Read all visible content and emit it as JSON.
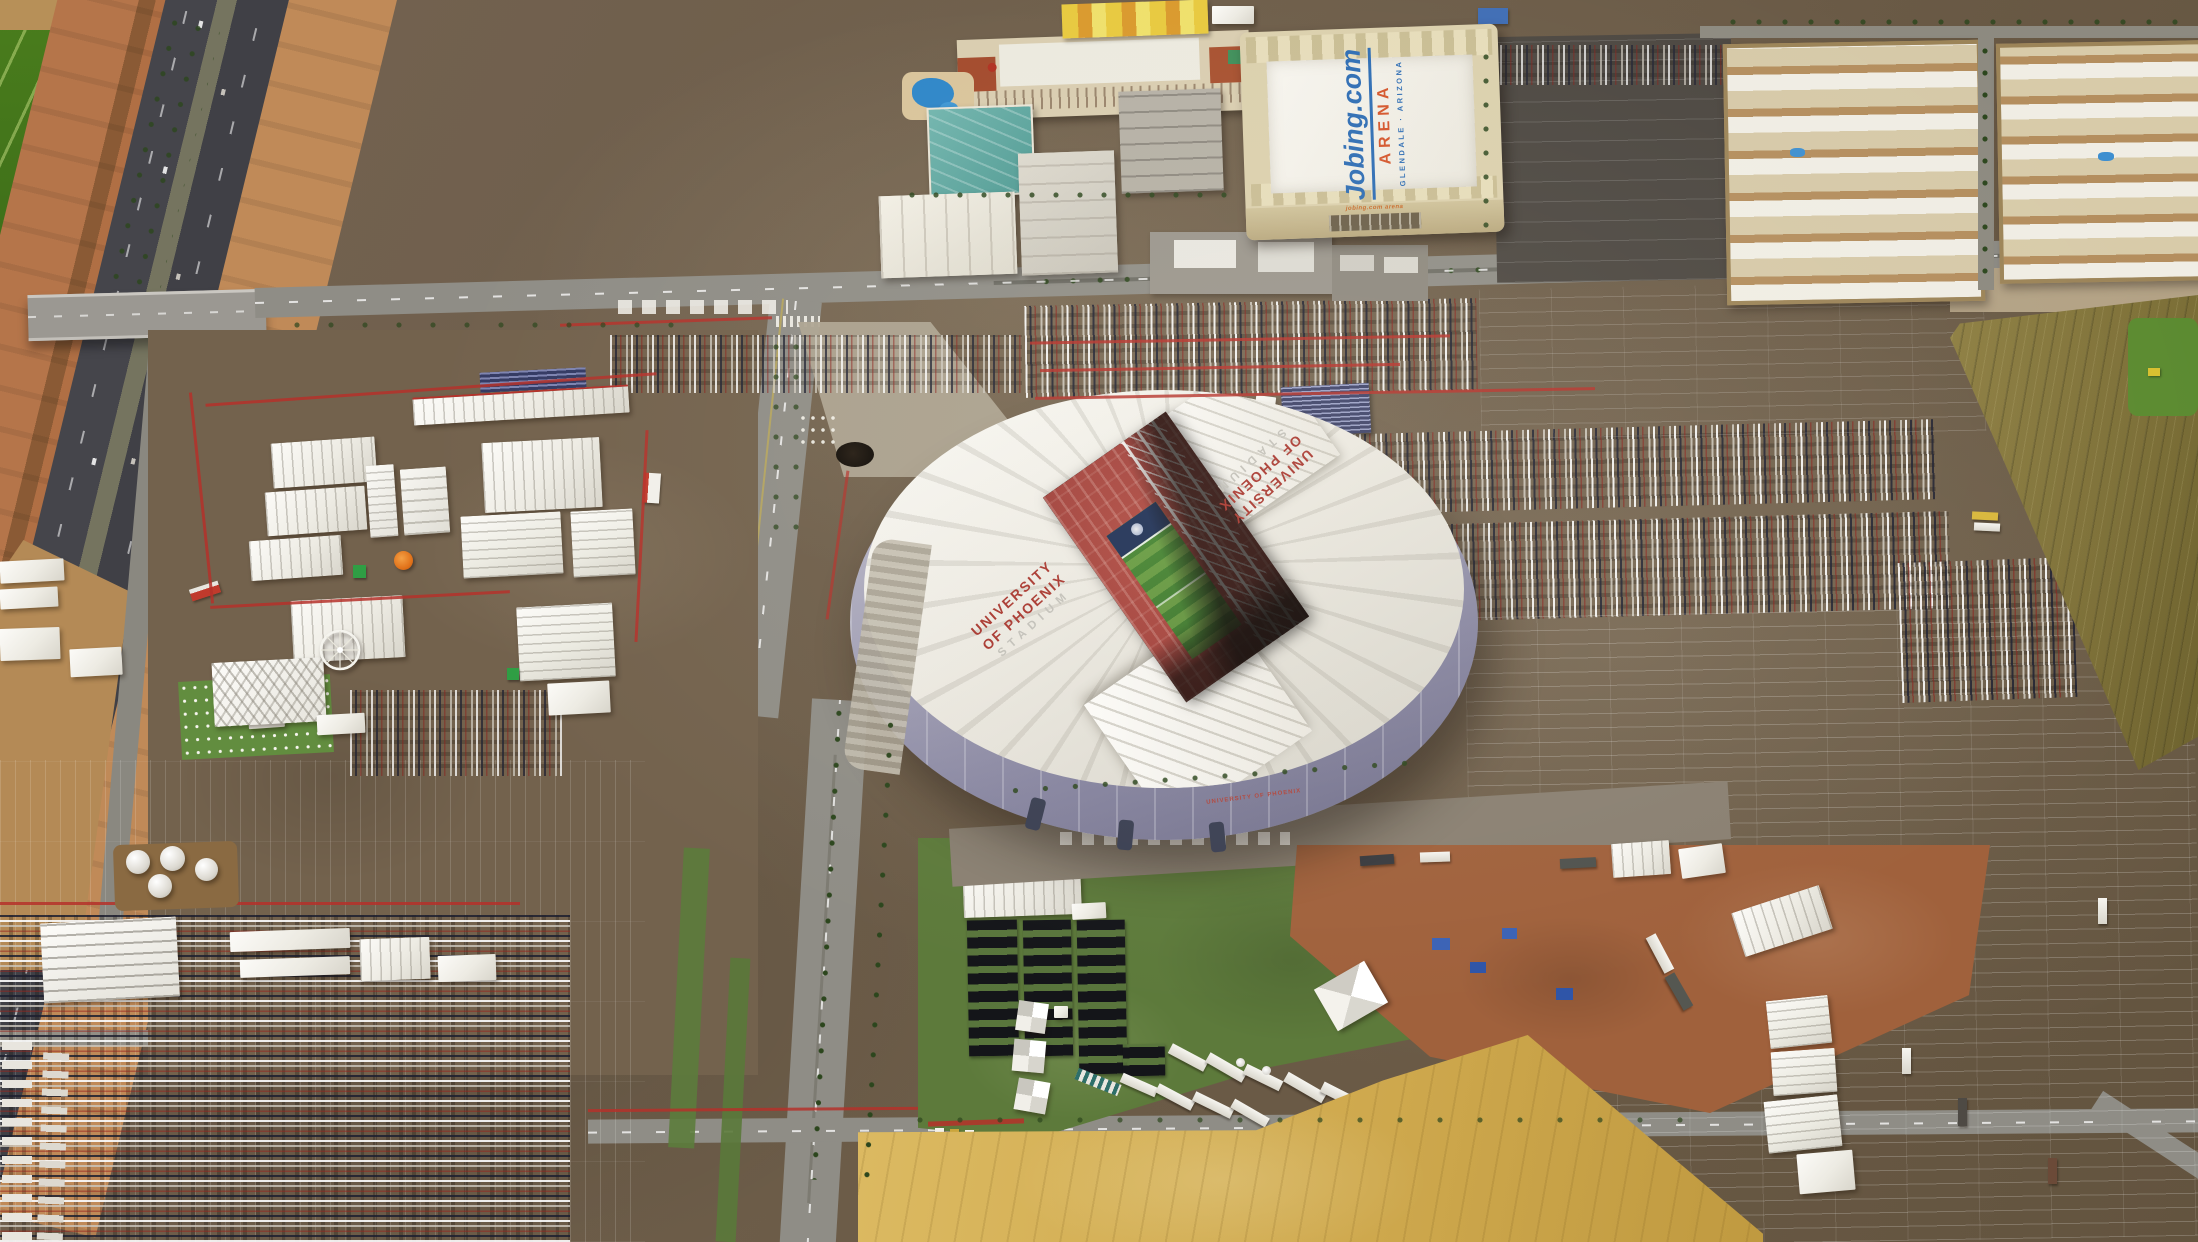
{
  "stadium": {
    "roof_text": {
      "line1": "UNIVERSITY",
      "line2": "OF PHOENIX",
      "line3": "STADIUM"
    },
    "wall_text": "UNIVERSITY OF PHOENIX",
    "colors": {
      "roof": "#edebe3",
      "wall": "#8f8da6",
      "seats": "#a2403a",
      "field": "#3f7b2e",
      "end_zone": "#1d2f55"
    }
  },
  "arena": {
    "roof_brand": "Jobing.com",
    "roof_name": "ARENA",
    "roof_location": "GLENDALE · ARIZONA",
    "facade_sign": "jobing.com arena",
    "colors": {
      "brand_blue": "#2e6db4",
      "arena_orange": "#d4552b",
      "roof": "#f2efe7",
      "walls": "#dbd0ad"
    }
  },
  "environment": {
    "colors": {
      "parking_brown": "#6e5e4a",
      "farm_green": "#47791b",
      "farm_olive": "#837637",
      "highway_asphalt": "#44444a",
      "dirt_orange": "#b06f44",
      "dry_field_yellow": "#d2ae52",
      "grass_green": "#5d7a3b",
      "tent_white": "#f2f0e9",
      "barricade_red": "#b5312a"
    }
  }
}
